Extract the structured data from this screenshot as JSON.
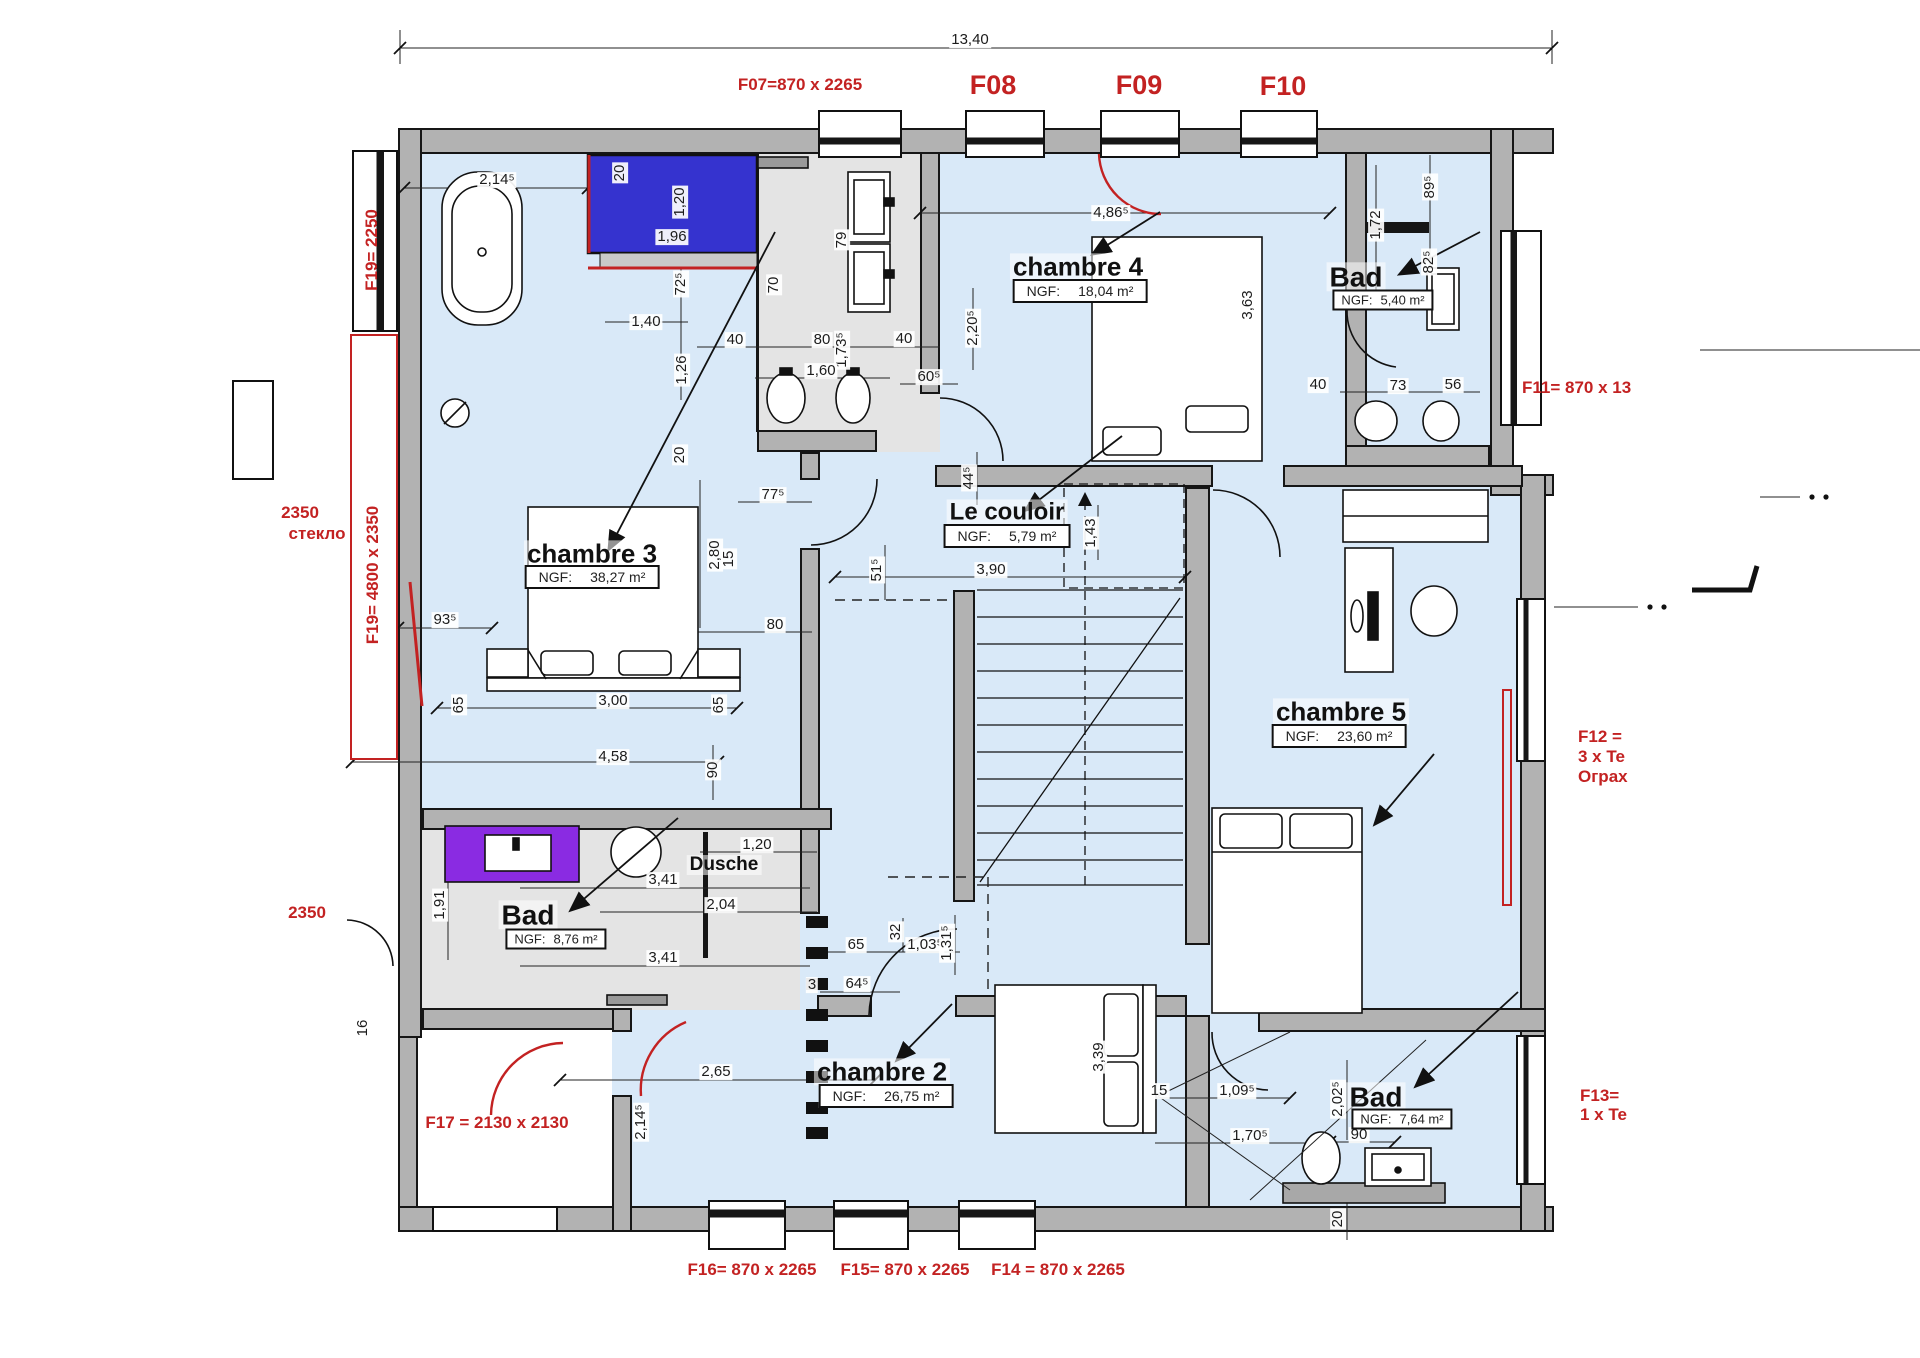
{
  "colors": {
    "wall": "#b2b2b2",
    "floor": "#d9e9f8",
    "bath": "#e4e4e4",
    "red": "#c32222",
    "furnblue": "#3533cf",
    "furnpurple": "#8a2be2",
    "slab": "#a8a8a8"
  },
  "window_labels": [
    {
      "t": "F07=870 x 2265",
      "x": 800,
      "y": 85
    },
    {
      "t": "F08",
      "x": 993,
      "y": 85,
      "big": 1
    },
    {
      "t": "F09",
      "x": 1139,
      "y": 85,
      "big": 1
    },
    {
      "t": "F10",
      "x": 1283,
      "y": 86,
      "big": 1
    },
    {
      "t": "F19= 2250",
      "x": 372,
      "y": 250,
      "r": 1
    },
    {
      "t": "2350",
      "x": 300,
      "y": 513
    },
    {
      "t": "стекло",
      "x": 317,
      "y": 534
    },
    {
      "t": "F19= 4800 x 2350",
      "x": 373,
      "y": 575,
      "r": 1
    },
    {
      "t": "2350",
      "x": 307,
      "y": 913
    },
    {
      "t": "F17 = 2130 x 2130",
      "x": 497,
      "y": 1123
    },
    {
      "t": "F11= 870 x 13",
      "x": 1522,
      "y": 388,
      "left": 1
    },
    {
      "t": "F12 =",
      "x": 1578,
      "y": 737,
      "left": 1
    },
    {
      "t": "3 x Te",
      "x": 1578,
      "y": 757,
      "left": 1
    },
    {
      "t": "Ограх",
      "x": 1578,
      "y": 777,
      "left": 1
    },
    {
      "t": "F13= ",
      "x": 1580,
      "y": 1096,
      "left": 1
    },
    {
      "t": "1 x Te",
      "x": 1580,
      "y": 1115,
      "left": 1
    },
    {
      "t": "F16= 870 x 2265",
      "x": 752,
      "y": 1270
    },
    {
      "t": "F15= 870 x 2265",
      "x": 905,
      "y": 1270
    },
    {
      "t": "F14 = 870 x 2265",
      "x": 1058,
      "y": 1270
    }
  ],
  "rooms": [
    {
      "name": "chambre 3",
      "ngf_label": "NGF:",
      "area": "38,27 m²",
      "x": 592,
      "y": 554,
      "bx": 592,
      "by": 577,
      "size": 26
    },
    {
      "name": "chambre 4",
      "ngf_label": "NGF:",
      "area": "18,04 m²",
      "x": 1078,
      "y": 267,
      "bx": 1080,
      "by": 291,
      "size": 26
    },
    {
      "name": "Le couloir",
      "ngf_label": "NGF:",
      "area": "5,79 m²",
      "x": 1007,
      "y": 512,
      "bx": 1007,
      "by": 536,
      "size": 24
    },
    {
      "name": "chambre 5",
      "ngf_label": "NGF:",
      "area": "23,60 m²",
      "x": 1341,
      "y": 712,
      "bx": 1339,
      "by": 736,
      "size": 26
    },
    {
      "name": "chambre 2",
      "ngf_label": "NGF:",
      "area": "26,75 m²",
      "x": 882,
      "y": 1072,
      "bx": 886,
      "by": 1096,
      "size": 26
    },
    {
      "name": "Bad",
      "ngf_label": "NGF:",
      "area": "5,40 m²",
      "x": 1356,
      "y": 277,
      "bx": 1383,
      "by": 300,
      "size": 28,
      "small": 1
    },
    {
      "name": "Bad",
      "ngf_label": "NGF:",
      "area": "8,76 m²",
      "x": 528,
      "y": 915,
      "bx": 556,
      "by": 939,
      "size": 28,
      "small": 1
    },
    {
      "name": "Bad",
      "ngf_label": "NGF:",
      "area": "7,64 m²",
      "x": 1376,
      "y": 1097,
      "bx": 1402,
      "by": 1119,
      "size": 28,
      "small": 1
    },
    {
      "name": "Dusche",
      "ngf_label": "",
      "area": null,
      "x": 724,
      "y": 865,
      "size": 19
    }
  ],
  "dimensions": [
    {
      "t": "13,40",
      "x": 970,
      "y": 40
    },
    {
      "t": "2,14⁵",
      "x": 497,
      "y": 180
    },
    {
      "t": "20",
      "x": 620,
      "y": 173,
      "r": 1
    },
    {
      "t": "1,20",
      "x": 680,
      "y": 202,
      "r": 1
    },
    {
      "t": "1,96",
      "x": 672,
      "y": 237
    },
    {
      "t": "72⁵",
      "x": 681,
      "y": 284,
      "r": 1
    },
    {
      "t": "1,40",
      "x": 646,
      "y": 322
    },
    {
      "t": "40",
      "x": 735,
      "y": 340
    },
    {
      "t": "80",
      "x": 822,
      "y": 340
    },
    {
      "t": "1,73⁵",
      "x": 842,
      "y": 350,
      "r": 1
    },
    {
      "t": "40",
      "x": 904,
      "y": 339
    },
    {
      "t": "1,60",
      "x": 821,
      "y": 371
    },
    {
      "t": "1,26",
      "x": 682,
      "y": 370,
      "r": 1
    },
    {
      "t": "70",
      "x": 774,
      "y": 285,
      "r": 1
    },
    {
      "t": "79",
      "x": 842,
      "y": 240,
      "r": 1
    },
    {
      "t": "60⁵",
      "x": 929,
      "y": 377
    },
    {
      "t": "2,20⁵",
      "x": 973,
      "y": 328,
      "r": 1
    },
    {
      "t": "4,86⁵",
      "x": 1111,
      "y": 213
    },
    {
      "t": "3,63",
      "x": 1248,
      "y": 305,
      "r": 1
    },
    {
      "t": "1,72",
      "x": 1376,
      "y": 225,
      "r": 1
    },
    {
      "t": "89⁵",
      "x": 1430,
      "y": 187,
      "r": 1
    },
    {
      "t": "82⁵",
      "x": 1429,
      "y": 262,
      "r": 1
    },
    {
      "t": "40",
      "x": 1318,
      "y": 385
    },
    {
      "t": "73",
      "x": 1398,
      "y": 386
    },
    {
      "t": "56",
      "x": 1453,
      "y": 385
    },
    {
      "t": "20",
      "x": 680,
      "y": 455,
      "r": 1
    },
    {
      "t": "77⁵",
      "x": 773,
      "y": 495
    },
    {
      "t": "2,80",
      "x": 715,
      "y": 555,
      "r": 1
    },
    {
      "t": "15",
      "x": 729,
      "y": 559,
      "r": 1
    },
    {
      "t": "44⁵",
      "x": 969,
      "y": 478,
      "r": 1
    },
    {
      "t": "1,43",
      "x": 1091,
      "y": 533,
      "r": 1
    },
    {
      "t": "3,90",
      "x": 991,
      "y": 570
    },
    {
      "t": "51⁵",
      "x": 877,
      "y": 570,
      "r": 1
    },
    {
      "t": "93⁵",
      "x": 445,
      "y": 620
    },
    {
      "t": "80",
      "x": 775,
      "y": 625
    },
    {
      "t": "65",
      "x": 459,
      "y": 705,
      "r": 1
    },
    {
      "t": "3,00",
      "x": 613,
      "y": 701
    },
    {
      "t": "65",
      "x": 719,
      "y": 705,
      "r": 1
    },
    {
      "t": "4,58",
      "x": 613,
      "y": 757
    },
    {
      "t": "90",
      "x": 713,
      "y": 770,
      "r": 1
    },
    {
      "t": "1,91",
      "x": 440,
      "y": 905,
      "r": 1
    },
    {
      "t": "3,41",
      "x": 663,
      "y": 880
    },
    {
      "t": "1,20",
      "x": 757,
      "y": 845
    },
    {
      "t": "2,04",
      "x": 721,
      "y": 905
    },
    {
      "t": "3,41",
      "x": 663,
      "y": 958
    },
    {
      "t": "16",
      "x": 363,
      "y": 1028,
      "r": 1
    },
    {
      "t": "2,65",
      "x": 716,
      "y": 1072
    },
    {
      "t": "2,14⁵",
      "x": 641,
      "y": 1122,
      "r": 1
    },
    {
      "t": "65",
      "x": 856,
      "y": 945
    },
    {
      "t": "32",
      "x": 896,
      "y": 932,
      "r": 1
    },
    {
      "t": "1,03⁵",
      "x": 925,
      "y": 945
    },
    {
      "t": "1,31⁵",
      "x": 947,
      "y": 943,
      "r": 1
    },
    {
      "t": "64⁵",
      "x": 857,
      "y": 984
    },
    {
      "t": "3",
      "x": 812,
      "y": 985
    },
    {
      "t": "3,39",
      "x": 1099,
      "y": 1057,
      "r": 1
    },
    {
      "t": "15",
      "x": 1159,
      "y": 1091
    },
    {
      "t": "1,09⁵",
      "x": 1237,
      "y": 1091
    },
    {
      "t": "2,02⁵",
      "x": 1338,
      "y": 1099,
      "r": 1
    },
    {
      "t": "1,70⁵",
      "x": 1250,
      "y": 1136
    },
    {
      "t": "90",
      "x": 1359,
      "y": 1135
    },
    {
      "t": "20",
      "x": 1338,
      "y": 1219,
      "r": 1
    }
  ]
}
